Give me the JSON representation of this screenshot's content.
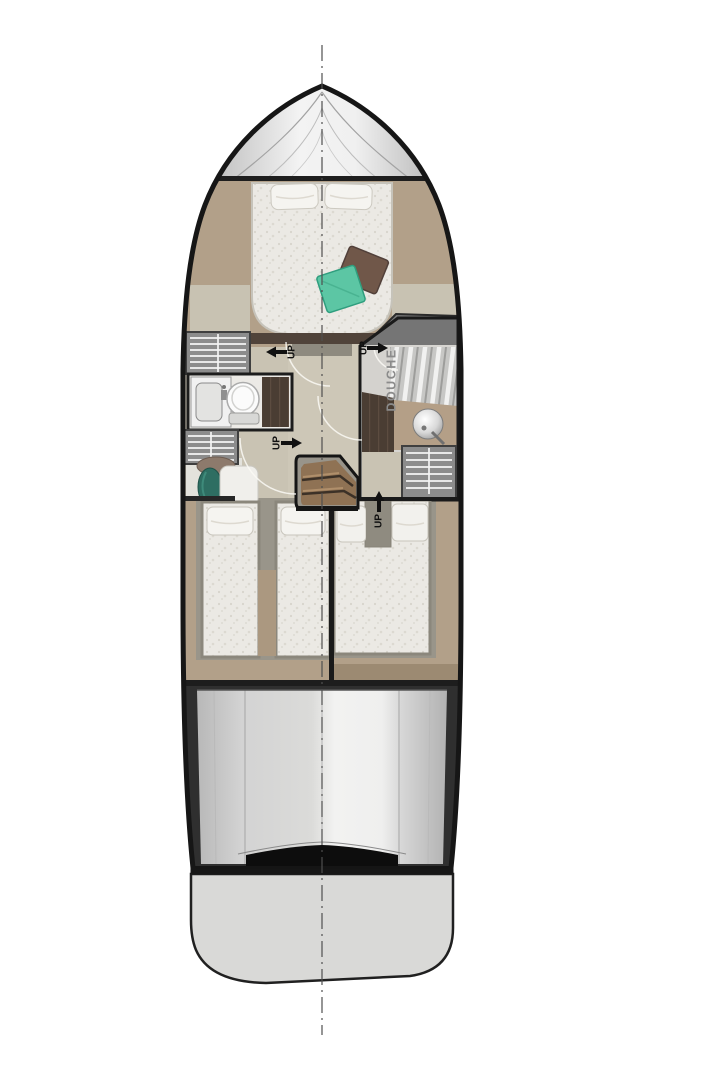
{
  "page": {
    "title": "Boat lower deck floor plan"
  },
  "plan": {
    "labels": {
      "up": "UP",
      "shower": "DOUCHE"
    },
    "icons": [
      "up-arrow-left-icon",
      "up-arrow-right-icon",
      "up-arrow-up-icon",
      "toilet",
      "sink",
      "washbasin-sphere",
      "shower-glass",
      "staircase",
      "deck-hatch"
    ],
    "colors": {
      "hull_outline": "#1a1a1a",
      "bow_deck": "#e9e9e9",
      "interior_floor": "#c9c3b3",
      "wood_floor": "#b2a089",
      "dark_wood": "#4a3d33",
      "mattress": "#ebe9e4",
      "pillow": "#f5f4f0",
      "teal_cushion": "#5cc6a4",
      "brown_cushion": "#705749",
      "teal_stool": "#2e6e62",
      "hatch_gray": "#8c8c8c",
      "stern_deck": "#d9d9d8",
      "swim_platform": "#dadad8",
      "stair_wood": "#8f7254",
      "label_text": "#111111",
      "shower_label_text": "#8b8b8b"
    }
  }
}
